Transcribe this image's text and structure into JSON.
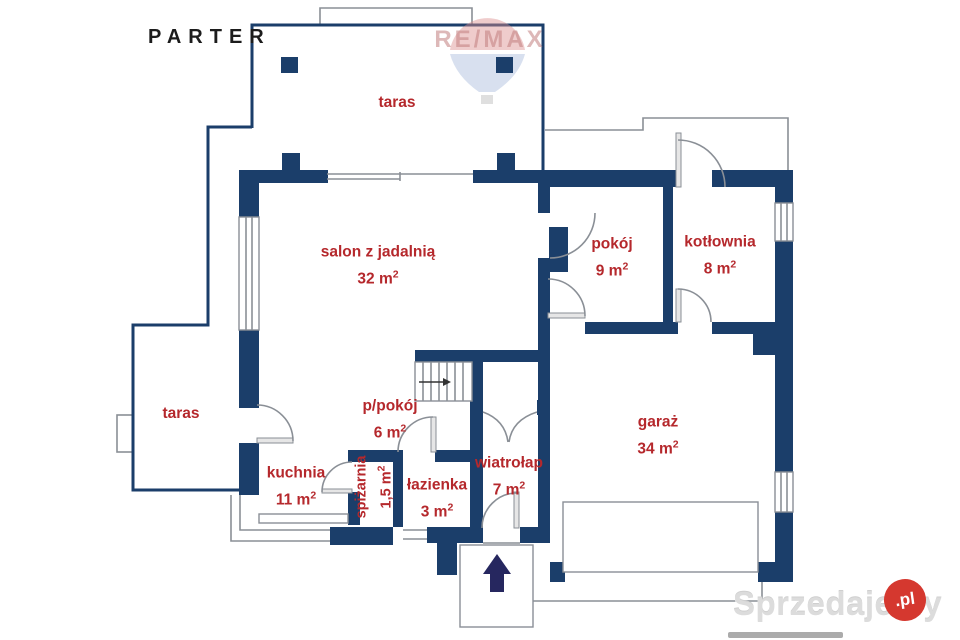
{
  "page": {
    "title": "PARTER"
  },
  "colors": {
    "wall": "#1b3e6a",
    "label_red": "#b5282c",
    "outline_gray": "#8a8f96",
    "entrance_arrow": "#26275f",
    "watermark_badge_red": "#d5382f",
    "watermark_bar_gray": "#ababab"
  },
  "rooms": [
    {
      "id": "taras-top",
      "name": "taras",
      "area": "",
      "sup": ""
    },
    {
      "id": "taras-left",
      "name": "taras",
      "area": "",
      "sup": ""
    },
    {
      "id": "salon",
      "name": "salon z jadalnią",
      "area": "32 m",
      "sup": "2"
    },
    {
      "id": "pokoj",
      "name": "pokój",
      "area": "9 m",
      "sup": "2"
    },
    {
      "id": "kotlownia",
      "name": "kotłownia",
      "area": "8 m",
      "sup": "2"
    },
    {
      "id": "kuchnia",
      "name": "kuchnia",
      "area": "11 m",
      "sup": "2"
    },
    {
      "id": "ppokoj",
      "name": "p/pokój",
      "area": "6 m",
      "sup": "2"
    },
    {
      "id": "spizarnia",
      "name": "spiżarnia",
      "area": "1,5 m",
      "sup": "2"
    },
    {
      "id": "lazienka",
      "name": "łazienka",
      "area": "3 m",
      "sup": "2"
    },
    {
      "id": "wiatrolap",
      "name": "wiatrołap",
      "area": "7 m",
      "sup": "2"
    },
    {
      "id": "garaz",
      "name": "garaż",
      "area": "34 m",
      "sup": "2"
    }
  ],
  "watermarks": {
    "remax": "RE/MAX",
    "site": "Sprzedajemy",
    "site_tld": ".pl"
  }
}
